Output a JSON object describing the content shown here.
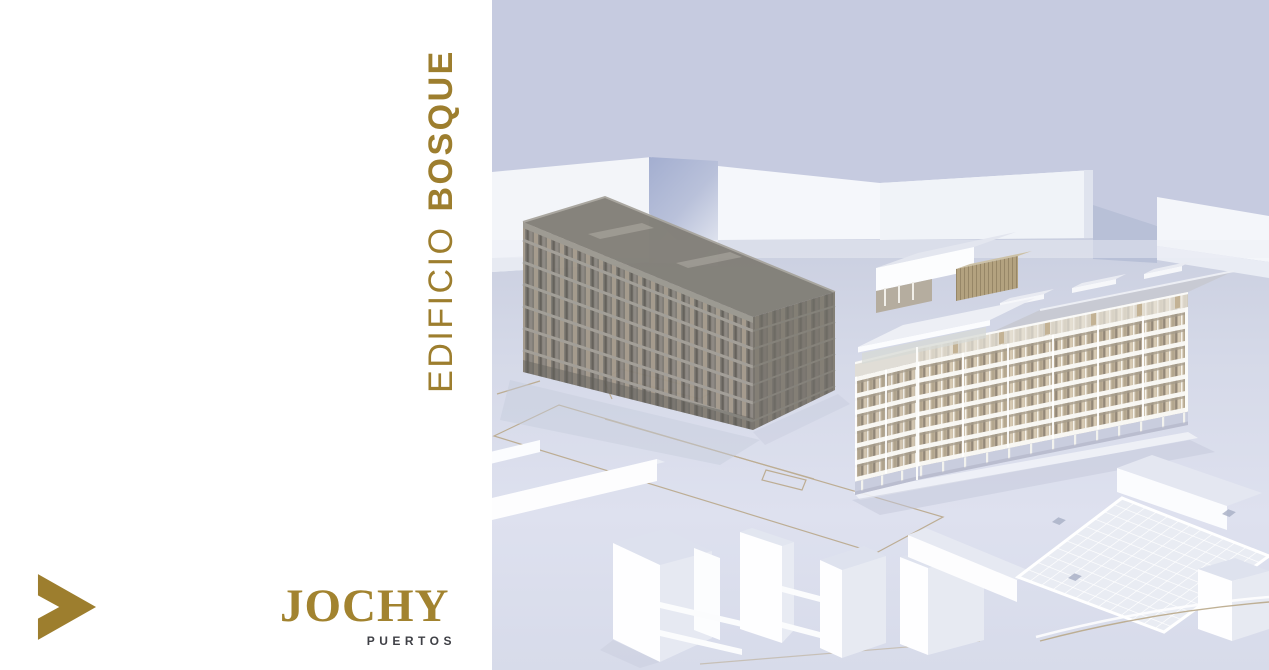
{
  "slide": {
    "vertical_title": {
      "prefix": "EDIFICIO",
      "emphasis": "BOSQUE",
      "full": "EDIFICIO BOSQUE"
    },
    "brand": {
      "name": "JOCHY",
      "tagline": "PUERTOS"
    },
    "navigation": {
      "next_chevron_icon": "chevron-right"
    }
  },
  "colors": {
    "accent_gold": "#9D7E2E",
    "brand_gold": "#A2832F",
    "tagline_gray": "#3F4046",
    "panel_white": "#FFFFFF",
    "sky_lavender": "#C6CBE0",
    "ground_lavender": "#DADDEC",
    "context_grey_building": "#7D7972",
    "featured_building_tan": "#CDBFA8"
  },
  "illustration": {
    "type": "3d-architectural-render",
    "alt": "Aerial 3D massing render: cream apartment building with stacked white balcony slabs and roof canopy beside a translucent grey residential block, white context massing volumes, waffle-grid roof slab and plot lines under a lavender sky"
  }
}
